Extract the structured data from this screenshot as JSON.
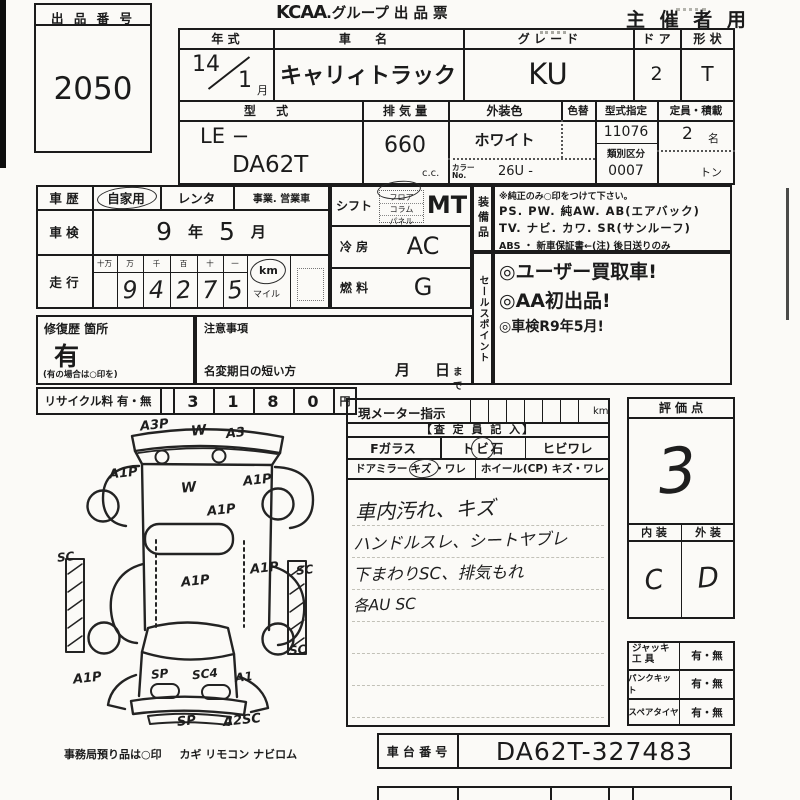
{
  "header": {
    "kcaa": "KCAA",
    "title_rest": ".グループ 出 品 票",
    "organizer": "主 催 者 用"
  },
  "auction_no": {
    "label": "出 品 番 号",
    "value": "2050"
  },
  "vehicle": {
    "year": {
      "label": "年  式",
      "value": "14",
      "month_value": "1",
      "month_unit": "月"
    },
    "name": {
      "label": "車  名",
      "value": "キャリィトラック"
    },
    "grade": {
      "label": "グ レ ー ド",
      "value": "KU"
    },
    "doors": {
      "label": "ド ア",
      "value": "2"
    },
    "shape": {
      "label": "形 状",
      "value": "T"
    },
    "model": {
      "label": "型  式",
      "value1": "LE  −",
      "value2": "DA62T"
    },
    "displacement": {
      "label": "排 気 量",
      "value": "660",
      "unit": "c.c."
    },
    "color": {
      "label": "外装色",
      "value": "ホワイト",
      "no_label": "カラーNo.",
      "no_value": "26U -"
    },
    "color_change": {
      "label": "色替"
    },
    "type_designation": {
      "label": "型式指定",
      "value": "11076",
      "class_label": "類別区分",
      "class_value": "0007"
    },
    "capacity": {
      "label": "定員・積載",
      "persons": "2",
      "persons_unit": "名",
      "load_unit": "トン"
    }
  },
  "history": {
    "career": {
      "label": "車 歴",
      "opt1": "自家用",
      "opt2": "レンタ",
      "opt3": "事業. 営業車"
    },
    "inspection": {
      "label": "車 検",
      "year": "9",
      "year_unit": "年",
      "month": "5",
      "month_unit": "月"
    },
    "mileage": {
      "label": "走 行",
      "headers": [
        "十万",
        "万",
        "千",
        "百",
        "十",
        "一"
      ],
      "digits": [
        "",
        "9",
        "4",
        "2",
        "7",
        "5"
      ],
      "unit": "km",
      "unit_alt": "マイル"
    }
  },
  "controls": {
    "shift": {
      "label": "シフト",
      "options": [
        "フロア",
        "コラム",
        "パネル"
      ],
      "value": "MT"
    },
    "ac": {
      "label": "冷 房",
      "value": "AC"
    },
    "fuel": {
      "label": "燃 料",
      "value": "G"
    }
  },
  "equipment": {
    "strip": "装備品",
    "note": "※純正のみ○印をつけて下さい。",
    "lines": [
      "PS. PW. 純AW. AB(エアバック)",
      "TV. ナビ. カワ. SR(サンルーフ)",
      "ABS ・ 新車保証書←(注) 後日送りのみ"
    ]
  },
  "sales_points": {
    "strip": "セールスポイント",
    "lines": [
      "◎ユーザー買取車!",
      "◎AA初出品!",
      "◎車検R9年5月!"
    ]
  },
  "repair": {
    "label": "修復歴 箇所",
    "value": "有",
    "note": "(有の場合は○印を)"
  },
  "notice": {
    "label": "注意事項",
    "line": "名変期日の短い方",
    "month": "月",
    "day": "日",
    "suffix": "まで"
  },
  "recycle": {
    "label": "リサイクル料 有・無",
    "digits": [
      "3",
      "1",
      "8",
      "0"
    ],
    "unit": "円"
  },
  "meter": {
    "label": "現メーター指示",
    "unit": "km",
    "assessor": "【査 定 員 記 入】",
    "glass": {
      "c1": "Fガラス",
      "c2_pre": "ト",
      "c2_mark": "ビ",
      "c2_post": "石",
      "c3": "ヒビワレ"
    },
    "mirror": {
      "c1_label": "ドアミラー",
      "c1_mark": "キズ",
      "c1_rest": "・ワレ",
      "c2": "ホイール(CP)  キズ・ワレ"
    },
    "notes": [
      "車内汚れ、キズ",
      "ハンドルスレ、シートヤブレ",
      "下まわりSC、排気もれ",
      "各AU SC"
    ]
  },
  "rating": {
    "label": "評  価  点",
    "score": "3",
    "interior_label": "内 装",
    "exterior_label": "外 装",
    "interior": "C",
    "exterior": "D"
  },
  "tools": {
    "rows": [
      {
        "l1": "ジャッキ",
        "l2": "工  具",
        "v": "有・無"
      },
      {
        "l1": "パンクキット",
        "l2": "",
        "v": "有・無"
      },
      {
        "l1": "スペアタイヤ",
        "l2": "",
        "v": "有・無"
      }
    ]
  },
  "chassis": {
    "label": "車 台 番 号",
    "value": "DA62T-327483"
  },
  "deposit_note": {
    "prefix": "事務局預り品は○印",
    "items": "カギ  リモコン  ナビロム"
  },
  "diagram": {
    "labels": [
      "A3P",
      "W",
      "A3",
      "A1P",
      "A1P",
      "W",
      "A1P",
      "SC",
      "A1P",
      "SC",
      "A1P",
      "SC",
      "A1P",
      "SP",
      "SC4",
      "A1",
      "SP",
      "A2SC"
    ]
  }
}
